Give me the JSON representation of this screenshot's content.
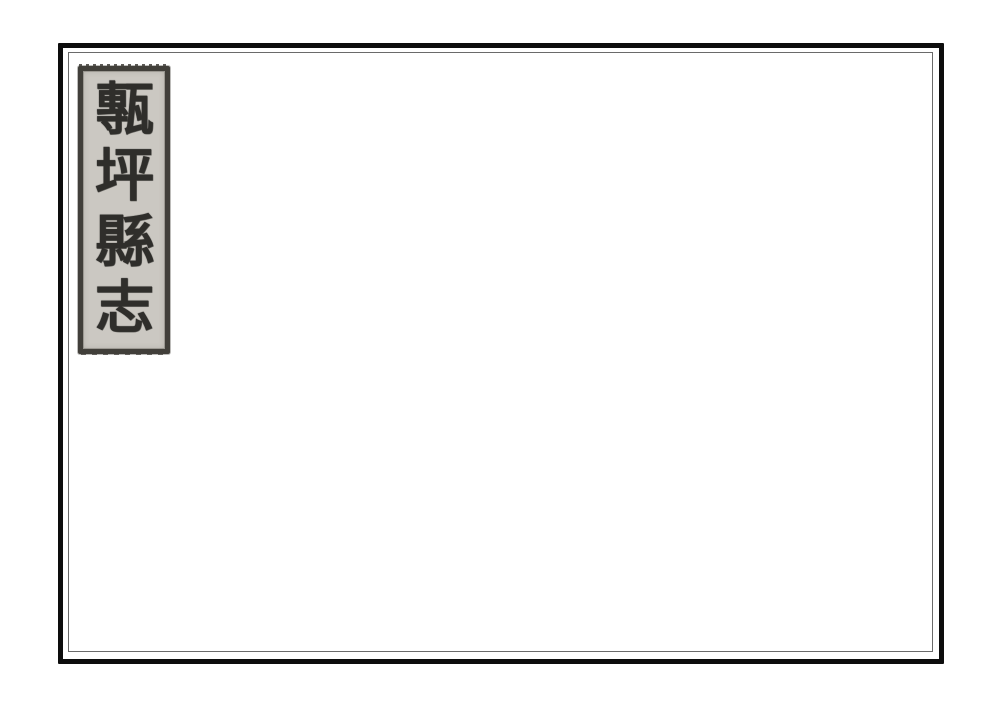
{
  "title_slip": {
    "text": "甎坪縣志",
    "characters": [
      "甎",
      "坪",
      "縣",
      "志"
    ],
    "reading_direction": "top-to-bottom"
  },
  "colors": {
    "page_bg": "#ffffff",
    "frame": "#0d0d0d",
    "inner_rule": "#6a6a6a",
    "slip_bg": "#cbc8c2",
    "slip_border": "#413f3a",
    "ink": "#2f2e2b"
  }
}
